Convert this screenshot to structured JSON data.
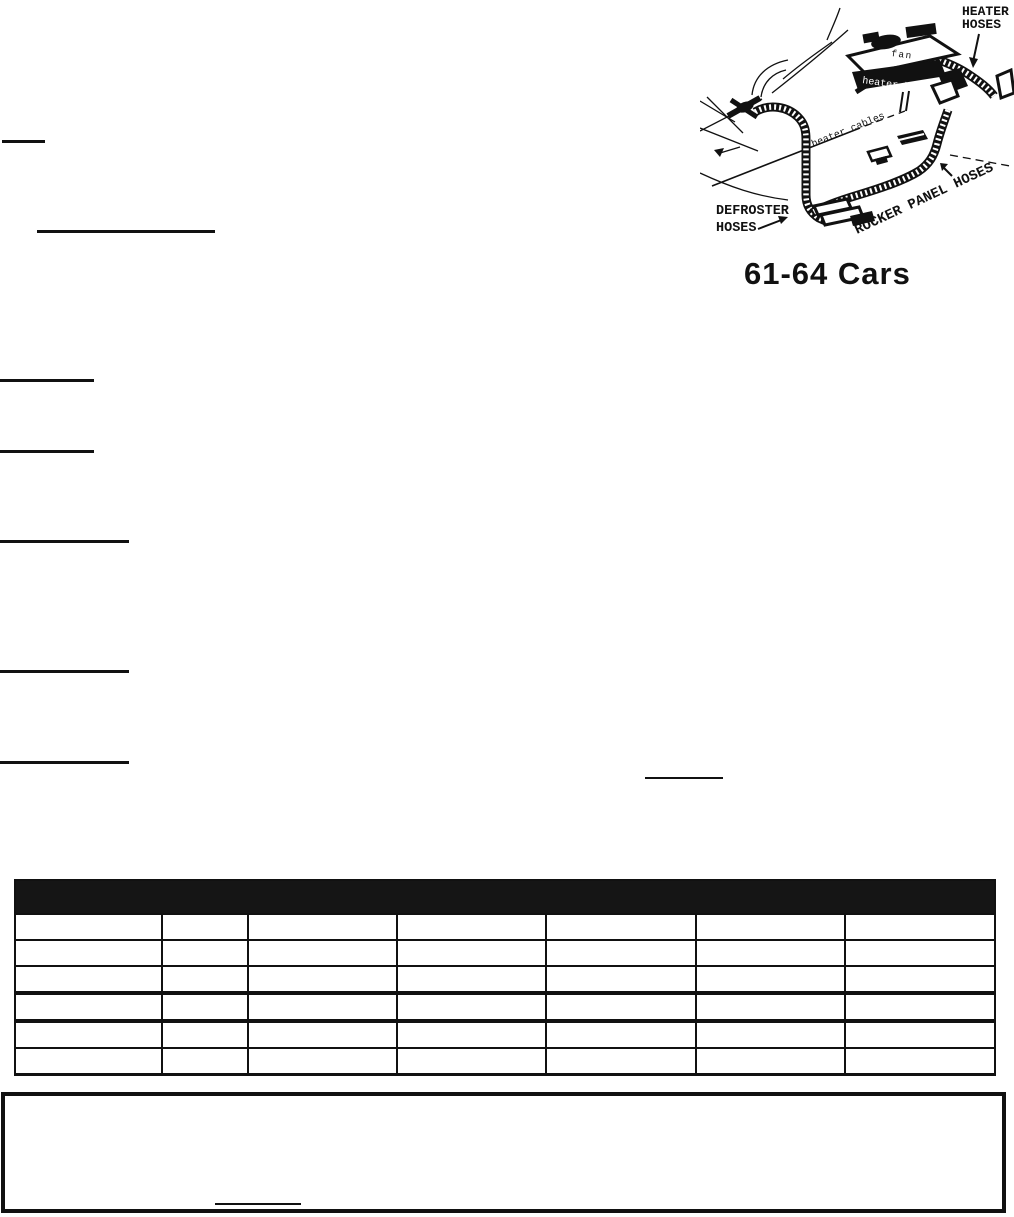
{
  "illustration": {
    "caption": "61-64 Cars",
    "labels": {
      "heater_hoses_line1": "HEATER",
      "heater_hoses_line2": "HOSES",
      "fan": "fan",
      "heater_box": "heater box",
      "heater_cables": "heater cables",
      "defroster_line1": "DEFROSTER",
      "defroster_line2": "HOSES",
      "rocker_panel": "ROCKER PANEL HOSES"
    }
  },
  "table": {
    "columns": 7,
    "body_rows": 6,
    "header_text": ""
  },
  "colors": {
    "ink": "#111111",
    "paper": "#ffffff",
    "table_header_bg": "#151515"
  }
}
